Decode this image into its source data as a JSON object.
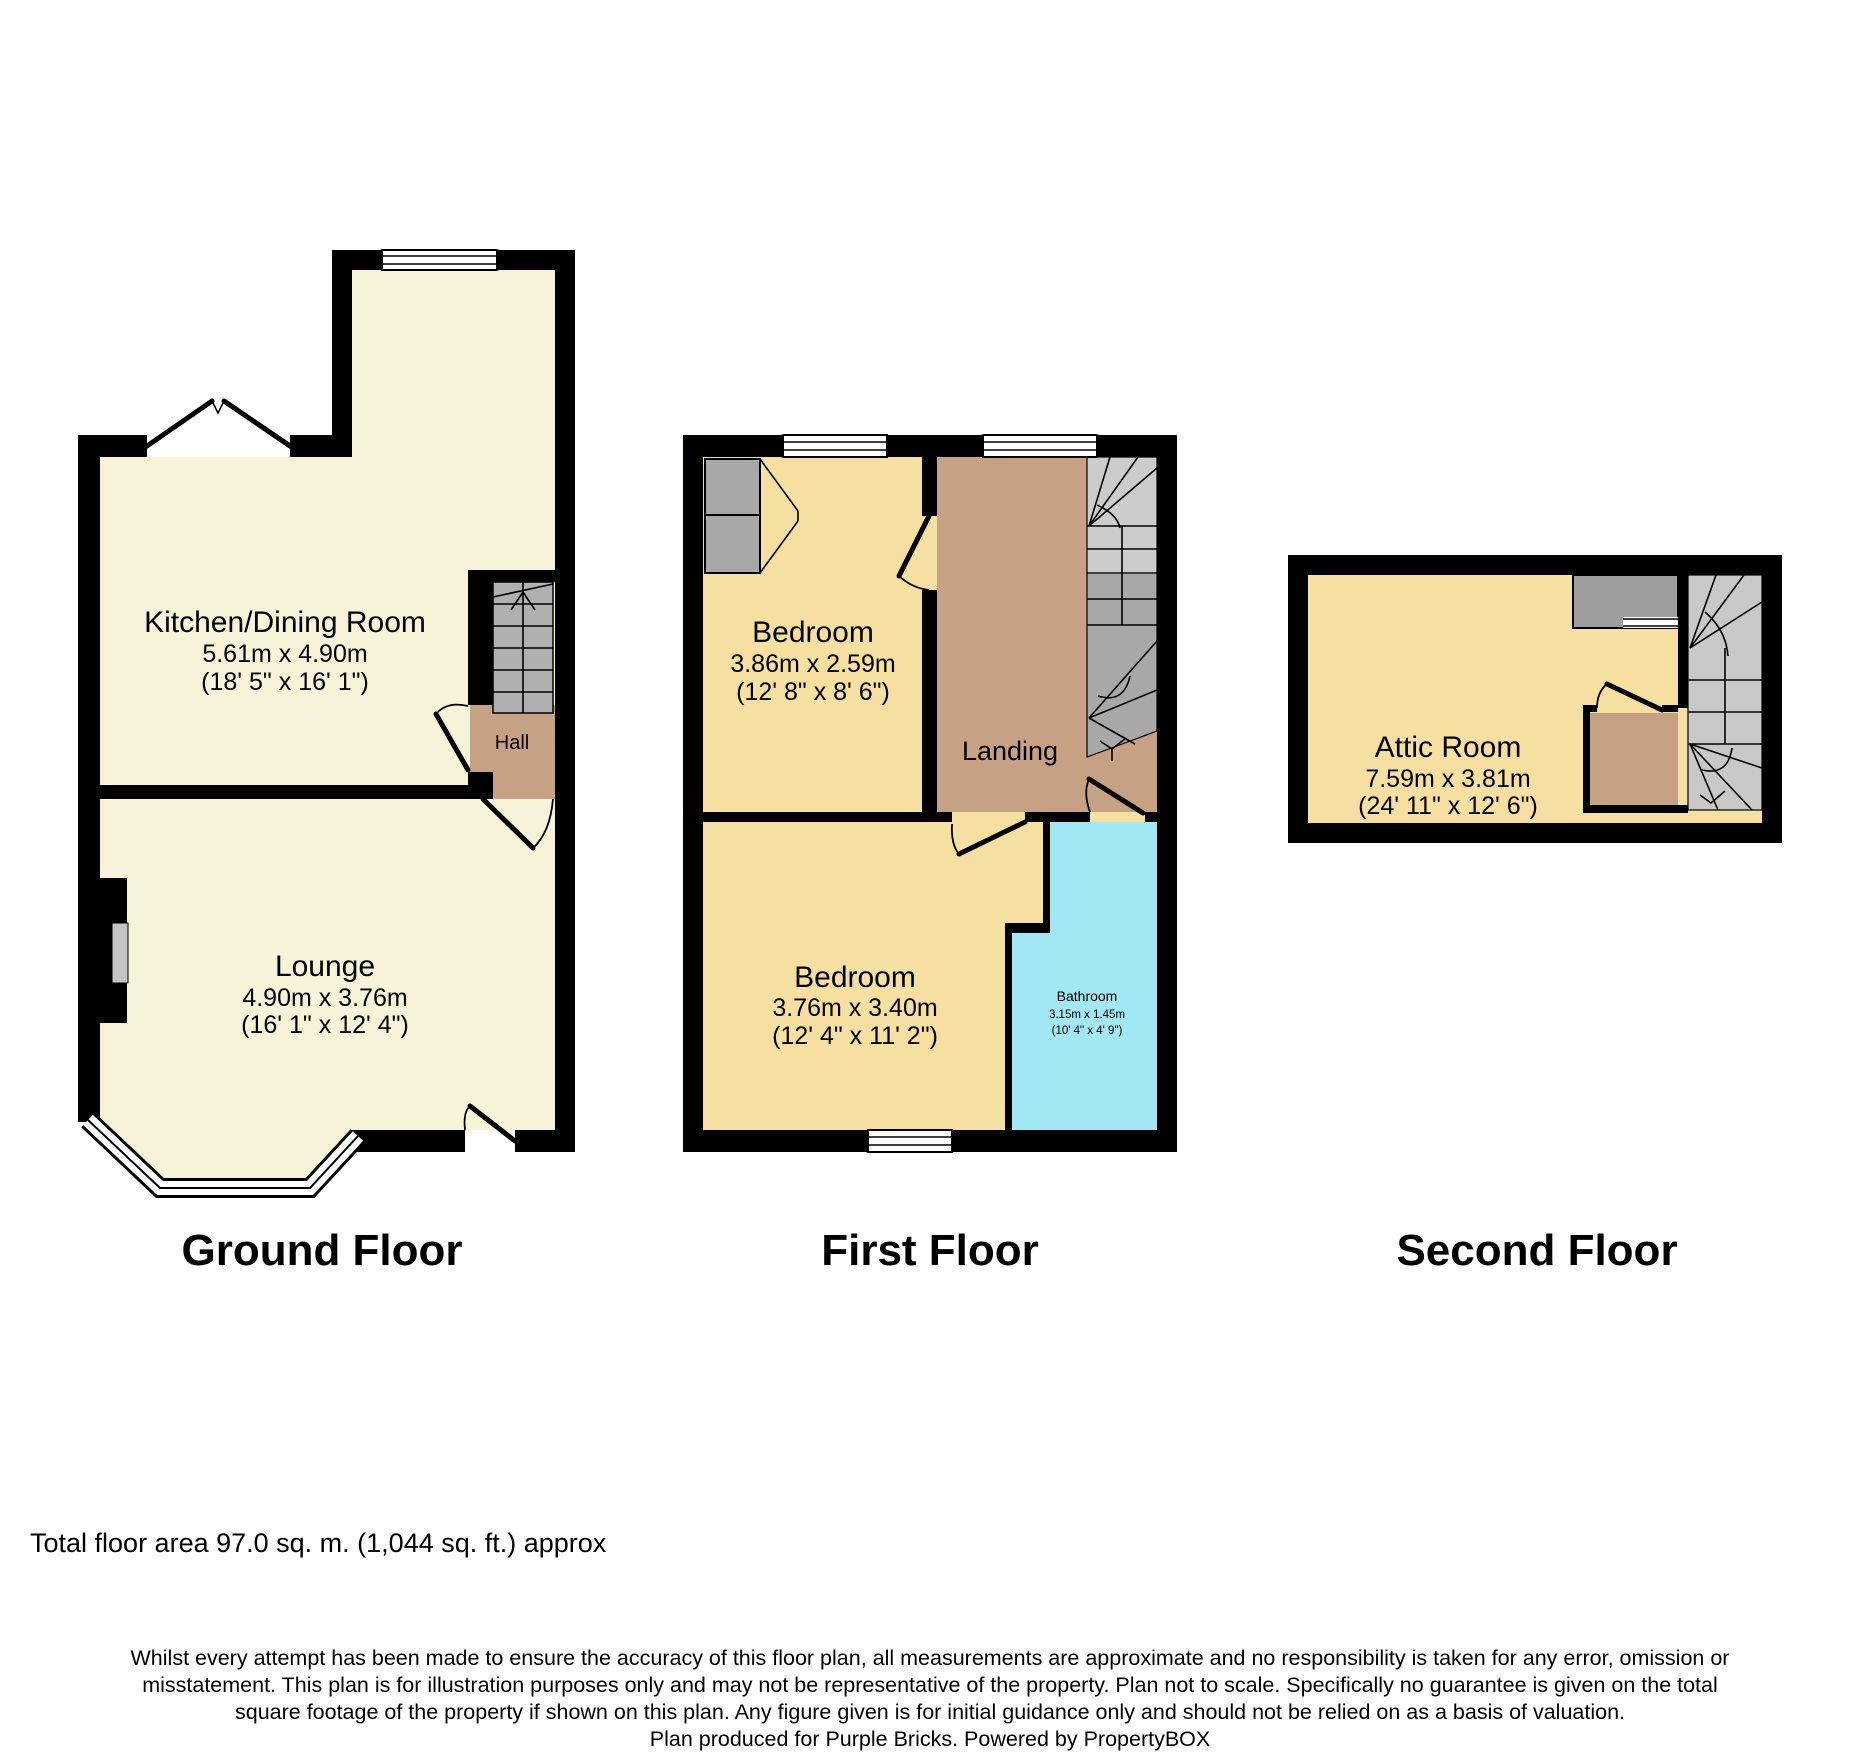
{
  "colors": {
    "wall": "#000000",
    "ground_room_fill": "#F7F3D8",
    "upper_room_fill": "#F5DFA1",
    "hall_fill": "#C7A183",
    "bathroom_fill": "#A2E7F4",
    "stair_ground": "#B0B0B0",
    "stair_up": "#CCCCCC",
    "stair_down": "#A8A8A8",
    "stair_second": "#C8C8C8",
    "wardrobe_fill": "#A8A8A8",
    "cupboard_fill": "#9E9E9E",
    "chimney_recess": "#C4C4C4"
  },
  "floors": {
    "ground": {
      "title": "Ground Floor",
      "rooms": {
        "kitchen": {
          "name": "Kitchen/Dining Room",
          "size_metric": "5.61m x 4.90m",
          "size_imperial": "(18' 5\" x 16' 1\")"
        },
        "hall": {
          "name": "Hall"
        },
        "lounge": {
          "name": "Lounge",
          "size_metric": "4.90m x 3.76m",
          "size_imperial": "(16' 1\" x 12' 4\")"
        }
      }
    },
    "first": {
      "title": "First Floor",
      "rooms": {
        "bedroom_rear": {
          "name": "Bedroom",
          "size_metric": "3.86m x 2.59m",
          "size_imperial": "(12' 8\" x 8' 6\")"
        },
        "landing": {
          "name": "Landing"
        },
        "bedroom_front": {
          "name": "Bedroom",
          "size_metric": "3.76m x 3.40m",
          "size_imperial": "(12' 4\" x 11' 2\")"
        },
        "bathroom": {
          "name": "Bathroom",
          "size_metric": "3.15m x 1.45m",
          "size_imperial": "(10' 4\" x 4' 9\")"
        }
      }
    },
    "second": {
      "title": "Second Floor",
      "rooms": {
        "attic": {
          "name": "Attic Room",
          "size_metric": "7.59m x 3.81m",
          "size_imperial": "(24' 11\" x 12' 6\")"
        }
      }
    }
  },
  "footer": {
    "total_area": "Total floor area 97.0 sq. m. (1,044 sq. ft.) approx",
    "disclaimer_lines": [
      "Whilst every attempt has been made to ensure the accuracy of this floor plan, all measurements are approximate and no responsibility is taken for any error, omission or",
      "misstatement. This plan is for illustration purposes only and may not be representative of the property. Plan not to scale. Specifically no guarantee is given on the total",
      "square footage of the property if shown on this plan. Any figure given is for initial guidance only and should not be relied on as a basis of valuation.",
      "Plan produced for Purple Bricks. Powered by PropertyBOX"
    ]
  }
}
